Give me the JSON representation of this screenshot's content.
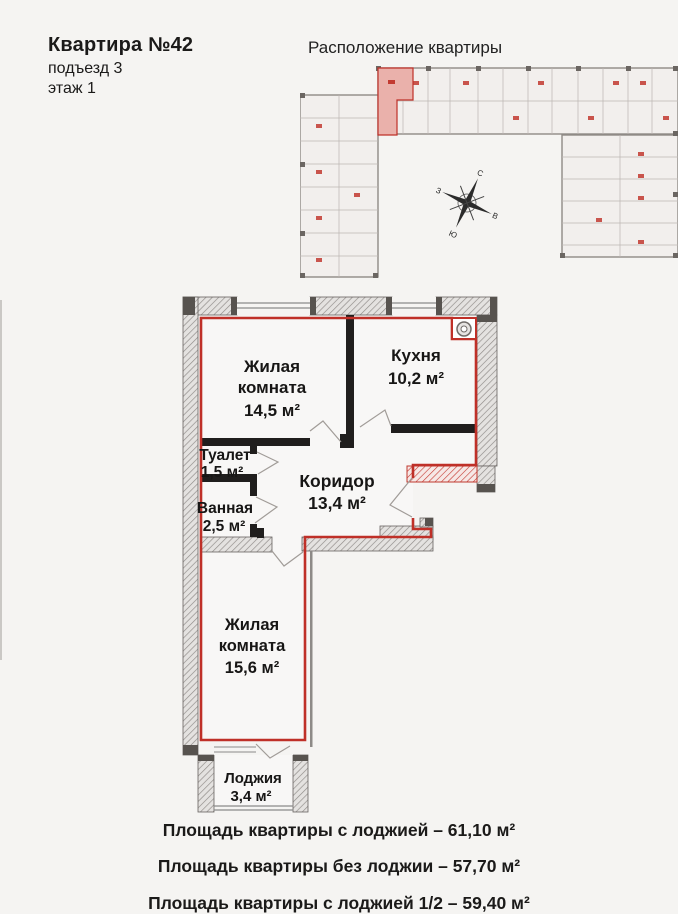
{
  "header": {
    "title": "Квартира №42",
    "entrance": "подъезд 3",
    "floor": "этаж 1"
  },
  "location_plan": {
    "title": "Расположение квартиры"
  },
  "compass": {
    "north": "С",
    "east": "В",
    "south": "Ю",
    "west": "З"
  },
  "rooms": {
    "living1": {
      "line1": "Жилая",
      "line2": "комната",
      "area": "14,5 м²"
    },
    "kitchen": {
      "name": "Кухня",
      "area": "10,2 м²"
    },
    "toilet": {
      "name": "Туалет",
      "area": "1,5 м²"
    },
    "bathroom": {
      "name": "Ванная",
      "area": "2,5 м²"
    },
    "corridor": {
      "name": "Коридор",
      "area": "13,4 м²"
    },
    "living2": {
      "line1": "Жилая",
      "line2": "комната",
      "area": "15,6 м²"
    },
    "loggia": {
      "name": "Лоджия",
      "area": "3,4 м²"
    }
  },
  "summary": {
    "with_loggia": "Площадь квартиры с лоджией – 61,10 м²",
    "without_loggia": "Площадь квартиры без лоджии – 57,70 м²",
    "with_half_loggia": "Площадь квартиры с лоджией 1/2 – 59,40 м²"
  },
  "colors": {
    "accent_red": "#bf3028",
    "highlight_pink": "#eab1ab",
    "wall_dark": "#201e1d"
  }
}
